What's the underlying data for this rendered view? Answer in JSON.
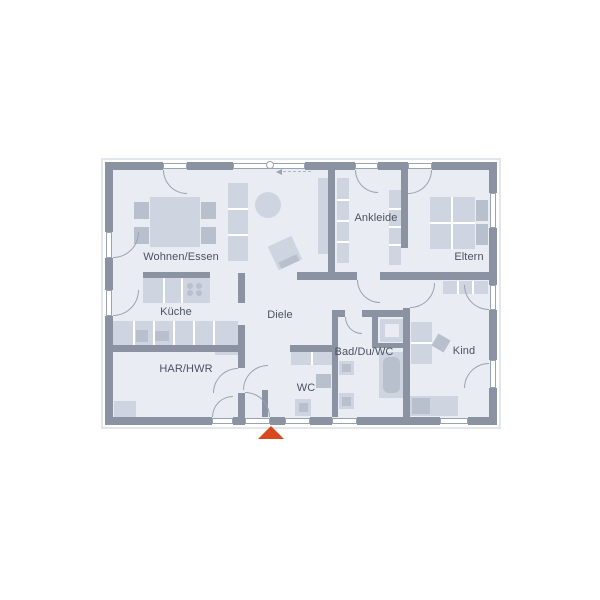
{
  "plan": {
    "colors": {
      "wall": "#8b93a3",
      "floor": "#e9edf3",
      "furn": "#cfd5e0",
      "furn2": "#b8bfcd",
      "white": "#ffffff",
      "line": "#9aa3b0",
      "light": "#e3e7ed",
      "text": "#4b515e",
      "accent": "#d8481f"
    },
    "rooms": [
      {
        "id": "wohnen-essen",
        "label": "Wohnen/Essen",
        "cx": 181,
        "cy": 257
      },
      {
        "id": "kueche",
        "label": "Küche",
        "cx": 176,
        "cy": 312
      },
      {
        "id": "har-hwr",
        "label": "HAR/HWR",
        "cx": 186,
        "cy": 369
      },
      {
        "id": "diele",
        "label": "Diele",
        "cx": 280,
        "cy": 315
      },
      {
        "id": "wc",
        "label": "WC",
        "cx": 306,
        "cy": 388
      },
      {
        "id": "bad-du-wc",
        "label": "Bad/Du/WC",
        "cx": 364,
        "cy": 352
      },
      {
        "id": "ankleide",
        "label": "Ankleide",
        "cx": 376,
        "cy": 218
      },
      {
        "id": "eltern",
        "label": "Eltern",
        "cx": 469,
        "cy": 257
      },
      {
        "id": "kind",
        "label": "Kind",
        "cx": 464,
        "cy": 351
      }
    ],
    "rects": [
      {
        "n": "plan-outline",
        "x": 101,
        "y": 158,
        "w": 400,
        "h": 271,
        "f": "none",
        "bd": 2,
        "bc": "light"
      },
      {
        "n": "floor",
        "x": 109,
        "y": 166,
        "w": 384,
        "h": 255,
        "f": "floor"
      },
      {
        "n": "dining-table",
        "x": 150,
        "y": 197,
        "w": 50,
        "h": 50,
        "f": "furn"
      },
      {
        "n": "chair",
        "x": 134,
        "y": 202,
        "w": 15,
        "h": 17,
        "f": "furn2"
      },
      {
        "n": "chair",
        "x": 134,
        "y": 227,
        "w": 15,
        "h": 17,
        "f": "furn2"
      },
      {
        "n": "chair",
        "x": 201,
        "y": 202,
        "w": 15,
        "h": 17,
        "f": "furn2"
      },
      {
        "n": "chair",
        "x": 201,
        "y": 227,
        "w": 15,
        "h": 17,
        "f": "furn2"
      },
      {
        "n": "sideboard",
        "x": 228,
        "y": 183,
        "w": 20,
        "h": 78,
        "f": "furn"
      },
      {
        "n": "sideboard-divider",
        "x": 228,
        "y": 208,
        "w": 20,
        "h": 2,
        "f": "white"
      },
      {
        "n": "sideboard-divider",
        "x": 228,
        "y": 234,
        "w": 20,
        "h": 2,
        "f": "white"
      },
      {
        "n": "armchair",
        "x": 272,
        "y": 240,
        "w": 26,
        "h": 26,
        "f": "furn",
        "rot": -25
      },
      {
        "n": "armchair-back",
        "x": 279,
        "y": 258,
        "w": 20,
        "h": 7,
        "f": "furn2",
        "rot": -25
      },
      {
        "n": "kitchen-island",
        "x": 143,
        "y": 278,
        "w": 67,
        "h": 25,
        "f": "furn"
      },
      {
        "n": "island-divider",
        "x": 163,
        "y": 278,
        "w": 2,
        "h": 25,
        "f": "white"
      },
      {
        "n": "island-divider",
        "x": 181,
        "y": 278,
        "w": 2,
        "h": 25,
        "f": "white"
      },
      {
        "n": "kitchen-counter",
        "x": 113,
        "y": 321,
        "w": 125,
        "h": 24,
        "f": "furn"
      },
      {
        "n": "counter-divider",
        "x": 133,
        "y": 321,
        "w": 2,
        "h": 24,
        "f": "white"
      },
      {
        "n": "counter-divider",
        "x": 153,
        "y": 321,
        "w": 2,
        "h": 24,
        "f": "white"
      },
      {
        "n": "counter-divider",
        "x": 173,
        "y": 321,
        "w": 2,
        "h": 24,
        "f": "white"
      },
      {
        "n": "counter-divider",
        "x": 193,
        "y": 321,
        "w": 2,
        "h": 24,
        "f": "white"
      },
      {
        "n": "counter-divider",
        "x": 213,
        "y": 321,
        "w": 2,
        "h": 24,
        "f": "white"
      },
      {
        "n": "kitchen-sink",
        "x": 136,
        "y": 330,
        "w": 12,
        "h": 12,
        "f": "furn2"
      },
      {
        "n": "kitchen-appliance",
        "x": 155,
        "y": 331,
        "w": 14,
        "h": 10,
        "f": "furn2"
      },
      {
        "n": "har-cabinet",
        "x": 215,
        "y": 332,
        "w": 23,
        "h": 23,
        "f": "furn"
      },
      {
        "n": "har-appliance",
        "x": 114,
        "y": 401,
        "w": 22,
        "h": 17,
        "f": "furn"
      },
      {
        "n": "hall-wardrobe",
        "x": 318,
        "y": 178,
        "w": 10,
        "h": 76,
        "f": "furn"
      },
      {
        "n": "ankleide-wardrobe",
        "x": 337,
        "y": 178,
        "w": 12,
        "h": 85,
        "f": "furn"
      },
      {
        "n": "wardrobe-divider",
        "x": 337,
        "y": 199,
        "w": 12,
        "h": 2,
        "f": "white"
      },
      {
        "n": "wardrobe-divider",
        "x": 337,
        "y": 220,
        "w": 12,
        "h": 2,
        "f": "white"
      },
      {
        "n": "wardrobe-divider",
        "x": 337,
        "y": 241,
        "w": 12,
        "h": 2,
        "f": "white"
      },
      {
        "n": "ankleide-wardrobe",
        "x": 389,
        "y": 190,
        "w": 12,
        "h": 75,
        "f": "furn"
      },
      {
        "n": "wardrobe-divider",
        "x": 389,
        "y": 208,
        "w": 12,
        "h": 2,
        "f": "white"
      },
      {
        "n": "wardrobe-divider",
        "x": 389,
        "y": 226,
        "w": 12,
        "h": 2,
        "f": "white"
      },
      {
        "n": "wardrobe-divider",
        "x": 389,
        "y": 244,
        "w": 12,
        "h": 2,
        "f": "white"
      },
      {
        "n": "eltern-bed",
        "x": 430,
        "y": 197,
        "w": 45,
        "h": 52,
        "f": "furn"
      },
      {
        "n": "bed-divider",
        "x": 451,
        "y": 197,
        "w": 2,
        "h": 52,
        "f": "white"
      },
      {
        "n": "bed-divider",
        "x": 430,
        "y": 222,
        "w": 45,
        "h": 2,
        "f": "white"
      },
      {
        "n": "pillow",
        "x": 476,
        "y": 200,
        "w": 12,
        "h": 21,
        "f": "furn2"
      },
      {
        "n": "pillow",
        "x": 476,
        "y": 224,
        "w": 12,
        "h": 21,
        "f": "furn2"
      },
      {
        "n": "kind-wardrobe",
        "x": 443,
        "y": 281,
        "w": 45,
        "h": 13,
        "f": "furn"
      },
      {
        "n": "wardrobe-divider",
        "x": 457,
        "y": 281,
        "w": 2,
        "h": 13,
        "f": "white"
      },
      {
        "n": "wardrobe-divider",
        "x": 472,
        "y": 281,
        "w": 2,
        "h": 13,
        "f": "white"
      },
      {
        "n": "kind-wardrobe",
        "x": 411,
        "y": 322,
        "w": 21,
        "h": 42,
        "f": "furn"
      },
      {
        "n": "wardrobe-divider",
        "x": 411,
        "y": 342,
        "w": 21,
        "h": 2,
        "f": "white"
      },
      {
        "n": "desk-chair",
        "x": 434,
        "y": 336,
        "w": 14,
        "h": 14,
        "f": "furn2",
        "rot": 30
      },
      {
        "n": "kind-bed",
        "x": 410,
        "y": 396,
        "w": 48,
        "h": 20,
        "f": "furn"
      },
      {
        "n": "pillow",
        "x": 412,
        "y": 398,
        "w": 18,
        "h": 16,
        "f": "furn2"
      },
      {
        "n": "wc-counter",
        "x": 291,
        "y": 352,
        "w": 41,
        "h": 13,
        "f": "furn"
      },
      {
        "n": "counter-divider",
        "x": 311,
        "y": 352,
        "w": 2,
        "h": 13,
        "f": "white"
      },
      {
        "n": "wc-sink",
        "x": 316,
        "y": 374,
        "w": 15,
        "h": 14,
        "f": "furn2"
      },
      {
        "n": "wc-toilet",
        "x": 295,
        "y": 399,
        "w": 16,
        "h": 17,
        "f": "furn"
      },
      {
        "n": "toilet-seat",
        "x": 299,
        "y": 403,
        "w": 9,
        "h": 9,
        "f": "furn2"
      },
      {
        "n": "shower",
        "x": 380,
        "y": 319,
        "w": 24,
        "h": 23,
        "f": "furn"
      },
      {
        "n": "shower-base",
        "x": 385,
        "y": 324,
        "w": 14,
        "h": 13,
        "f": "floor"
      },
      {
        "n": "bathtub",
        "x": 379,
        "y": 352,
        "w": 25,
        "h": 46,
        "f": "furn"
      },
      {
        "n": "bathtub-inner",
        "x": 383,
        "y": 357,
        "w": 17,
        "h": 36,
        "f": "furn2",
        "rad": 6
      },
      {
        "n": "bad-sink",
        "x": 339,
        "y": 361,
        "w": 15,
        "h": 14,
        "f": "furn"
      },
      {
        "n": "bad-sink-bowl",
        "x": 342,
        "y": 364,
        "w": 9,
        "h": 8,
        "f": "furn2"
      },
      {
        "n": "bad-toilet",
        "x": 339,
        "y": 393,
        "w": 15,
        "h": 16,
        "f": "furn"
      },
      {
        "n": "toilet-seat",
        "x": 342,
        "y": 397,
        "w": 9,
        "h": 9,
        "f": "furn2"
      },
      {
        "n": "wall-top",
        "x": 105,
        "y": 162,
        "w": 58,
        "h": 8,
        "f": "wall"
      },
      {
        "n": "wall-top",
        "x": 187,
        "y": 162,
        "w": 46,
        "h": 8,
        "f": "wall"
      },
      {
        "n": "wall-top",
        "x": 305,
        "y": 162,
        "w": 50,
        "h": 8,
        "f": "wall"
      },
      {
        "n": "wall-top",
        "x": 378,
        "y": 162,
        "w": 30,
        "h": 8,
        "f": "wall"
      },
      {
        "n": "wall-top",
        "x": 432,
        "y": 162,
        "w": 65,
        "h": 8,
        "f": "wall"
      },
      {
        "n": "wall-bottom",
        "x": 105,
        "y": 417,
        "w": 107,
        "h": 8,
        "f": "wall"
      },
      {
        "n": "wall-bottom",
        "x": 233,
        "y": 417,
        "w": 12,
        "h": 8,
        "f": "wall"
      },
      {
        "n": "wall-bottom",
        "x": 270,
        "y": 417,
        "w": 15,
        "h": 8,
        "f": "wall"
      },
      {
        "n": "wall-bottom",
        "x": 310,
        "y": 417,
        "w": 22,
        "h": 8,
        "f": "wall"
      },
      {
        "n": "wall-bottom",
        "x": 357,
        "y": 417,
        "w": 83,
        "h": 8,
        "f": "wall"
      },
      {
        "n": "wall-bottom",
        "x": 468,
        "y": 417,
        "w": 29,
        "h": 8,
        "f": "wall"
      },
      {
        "n": "wall-left",
        "x": 105,
        "y": 162,
        "w": 8,
        "h": 70,
        "f": "wall"
      },
      {
        "n": "wall-left",
        "x": 105,
        "y": 258,
        "w": 8,
        "h": 32,
        "f": "wall"
      },
      {
        "n": "wall-left",
        "x": 105,
        "y": 316,
        "w": 8,
        "h": 109,
        "f": "wall"
      },
      {
        "n": "wall-right",
        "x": 489,
        "y": 162,
        "w": 8,
        "h": 31,
        "f": "wall"
      },
      {
        "n": "wall-right",
        "x": 489,
        "y": 228,
        "w": 8,
        "h": 57,
        "f": "wall"
      },
      {
        "n": "wall-right",
        "x": 489,
        "y": 310,
        "w": 8,
        "h": 50,
        "f": "wall"
      },
      {
        "n": "wall-right",
        "x": 489,
        "y": 388,
        "w": 8,
        "h": 37,
        "f": "wall"
      },
      {
        "n": "wall-ankleide-west",
        "x": 328,
        "y": 170,
        "w": 7,
        "h": 103,
        "f": "wall"
      },
      {
        "n": "wall-ankleide-eltern",
        "x": 401,
        "y": 170,
        "w": 7,
        "h": 78,
        "f": "wall"
      },
      {
        "n": "wall-mid",
        "x": 297,
        "y": 272,
        "w": 60,
        "h": 8,
        "f": "wall"
      },
      {
        "n": "wall-mid",
        "x": 380,
        "y": 272,
        "w": 109,
        "h": 8,
        "f": "wall"
      },
      {
        "n": "wall-kind-west",
        "x": 403,
        "y": 308,
        "w": 7,
        "h": 109,
        "f": "wall"
      },
      {
        "n": "wall-kueche-stub",
        "x": 238,
        "y": 273,
        "w": 7,
        "h": 30,
        "f": "wall"
      },
      {
        "n": "wall-har-east",
        "x": 238,
        "y": 325,
        "w": 7,
        "h": 43,
        "f": "wall"
      },
      {
        "n": "wall-har-east",
        "x": 238,
        "y": 393,
        "w": 7,
        "h": 24,
        "f": "wall"
      },
      {
        "n": "wall-kueche-har",
        "x": 113,
        "y": 345,
        "w": 125,
        "h": 7,
        "f": "wall"
      },
      {
        "n": "wall-kitchen-half",
        "x": 143,
        "y": 272,
        "w": 67,
        "h": 6,
        "f": "wall"
      },
      {
        "n": "wall-bad-north",
        "x": 332,
        "y": 310,
        "w": 13,
        "h": 7,
        "f": "wall"
      },
      {
        "n": "wall-bad-north",
        "x": 362,
        "y": 310,
        "w": 41,
        "h": 7,
        "f": "wall"
      },
      {
        "n": "wall-bad-west",
        "x": 332,
        "y": 317,
        "w": 6,
        "h": 100,
        "f": "wall"
      },
      {
        "n": "wall-shower",
        "x": 372,
        "y": 317,
        "w": 6,
        "h": 26,
        "f": "wall"
      },
      {
        "n": "wall-shower",
        "x": 372,
        "y": 343,
        "w": 31,
        "h": 5,
        "f": "wall"
      },
      {
        "n": "wall-wc-north",
        "x": 290,
        "y": 345,
        "w": 42,
        "h": 7,
        "f": "wall"
      },
      {
        "n": "wall-wc-west",
        "x": 262,
        "y": 390,
        "w": 6,
        "h": 27,
        "f": "wall"
      },
      {
        "n": "window",
        "x": 163,
        "y": 163,
        "w": 24,
        "h": 6,
        "f": "white",
        "bd": 1
      },
      {
        "n": "window",
        "x": 233,
        "y": 163,
        "w": 72,
        "h": 6,
        "f": "white",
        "bd": 1
      },
      {
        "n": "window",
        "x": 355,
        "y": 163,
        "w": 23,
        "h": 6,
        "f": "white",
        "bd": 1
      },
      {
        "n": "window",
        "x": 408,
        "y": 163,
        "w": 24,
        "h": 6,
        "f": "white",
        "bd": 1
      },
      {
        "n": "window",
        "x": 106,
        "y": 232,
        "w": 6,
        "h": 26,
        "f": "white",
        "bd": 1
      },
      {
        "n": "window",
        "x": 106,
        "y": 290,
        "w": 6,
        "h": 26,
        "f": "white",
        "bd": 1
      },
      {
        "n": "window",
        "x": 490,
        "y": 193,
        "w": 6,
        "h": 35,
        "f": "white",
        "bd": 1
      },
      {
        "n": "window",
        "x": 490,
        "y": 285,
        "w": 6,
        "h": 25,
        "f": "white",
        "bd": 1
      },
      {
        "n": "window",
        "x": 490,
        "y": 360,
        "w": 6,
        "h": 28,
        "f": "white",
        "bd": 1
      },
      {
        "n": "window",
        "x": 212,
        "y": 418,
        "w": 21,
        "h": 6,
        "f": "white",
        "bd": 1
      },
      {
        "n": "entrance-threshold",
        "x": 245,
        "y": 418,
        "w": 25,
        "h": 6,
        "f": "white",
        "bd": 1
      },
      {
        "n": "window",
        "x": 285,
        "y": 418,
        "w": 25,
        "h": 6,
        "f": "white",
        "bd": 1
      },
      {
        "n": "window",
        "x": 332,
        "y": 418,
        "w": 25,
        "h": 6,
        "f": "white",
        "bd": 1
      },
      {
        "n": "window",
        "x": 440,
        "y": 418,
        "w": 28,
        "h": 6,
        "f": "white",
        "bd": 1
      }
    ],
    "arcs": [
      {
        "n": "door-arc-terrace-wohnen",
        "hx": 187,
        "hy": 170,
        "r": 24,
        "h": "tr"
      },
      {
        "n": "door-arc-terrace-ankleide",
        "hx": 378,
        "hy": 170,
        "r": 23,
        "h": "tr"
      },
      {
        "n": "door-arc-terrace-eltern",
        "hx": 408,
        "hy": 170,
        "r": 24,
        "h": "tl"
      },
      {
        "n": "door-arc-wohnen-west",
        "hx": 113,
        "hy": 232,
        "r": 26,
        "h": "tl"
      },
      {
        "n": "door-arc-kueche-west",
        "hx": 113,
        "hy": 290,
        "r": 26,
        "h": "tl"
      },
      {
        "n": "door-arc-kind-window1",
        "hx": 489,
        "hy": 285,
        "r": 25,
        "h": "tr"
      },
      {
        "n": "door-arc-kind-window2",
        "hx": 489,
        "hy": 388,
        "r": 25,
        "h": "br"
      },
      {
        "n": "door-arc-entrance",
        "hx": 245,
        "hy": 417,
        "r": 25,
        "h": "bl"
      },
      {
        "n": "door-arc-har-south",
        "hx": 233,
        "hy": 417,
        "r": 21,
        "h": "br"
      },
      {
        "n": "door-arc-har-diele",
        "hx": 238,
        "hy": 393,
        "r": 25,
        "h": "br"
      },
      {
        "n": "door-arc-wc",
        "hx": 268,
        "hy": 390,
        "r": 25,
        "h": "br"
      },
      {
        "n": "door-arc-bad",
        "hx": 362,
        "hy": 317,
        "r": 17,
        "h": "tr"
      },
      {
        "n": "door-arc-kind",
        "hx": 410,
        "hy": 283,
        "r": 25,
        "h": "tl"
      },
      {
        "n": "door-arc-flur",
        "hx": 380,
        "hy": 280,
        "r": 23,
        "h": "tr"
      }
    ],
    "circles": [
      {
        "n": "round-table",
        "cx": 268,
        "cy": 205,
        "r": 13,
        "f": "furn"
      },
      {
        "n": "cooktop-burner",
        "cx": 190,
        "cy": 286,
        "r": 3,
        "f": "furn2"
      },
      {
        "n": "cooktop-burner",
        "cx": 199,
        "cy": 286,
        "r": 3,
        "f": "furn2"
      },
      {
        "n": "cooktop-burner",
        "cx": 190,
        "cy": 293,
        "r": 3,
        "f": "furn2"
      },
      {
        "n": "cooktop-burner",
        "cx": 199,
        "cy": 293,
        "r": 3,
        "f": "furn2"
      },
      {
        "n": "wall-anchor-symbol",
        "cx": 270,
        "cy": 165,
        "r": 4,
        "f": "white",
        "bd": 1
      }
    ],
    "markers": {
      "entrance_triangle": {
        "x": 258,
        "y": 426,
        "size": 13
      },
      "direction_arrow": {
        "x": 276,
        "y": 169,
        "dash_w": 28
      }
    }
  }
}
